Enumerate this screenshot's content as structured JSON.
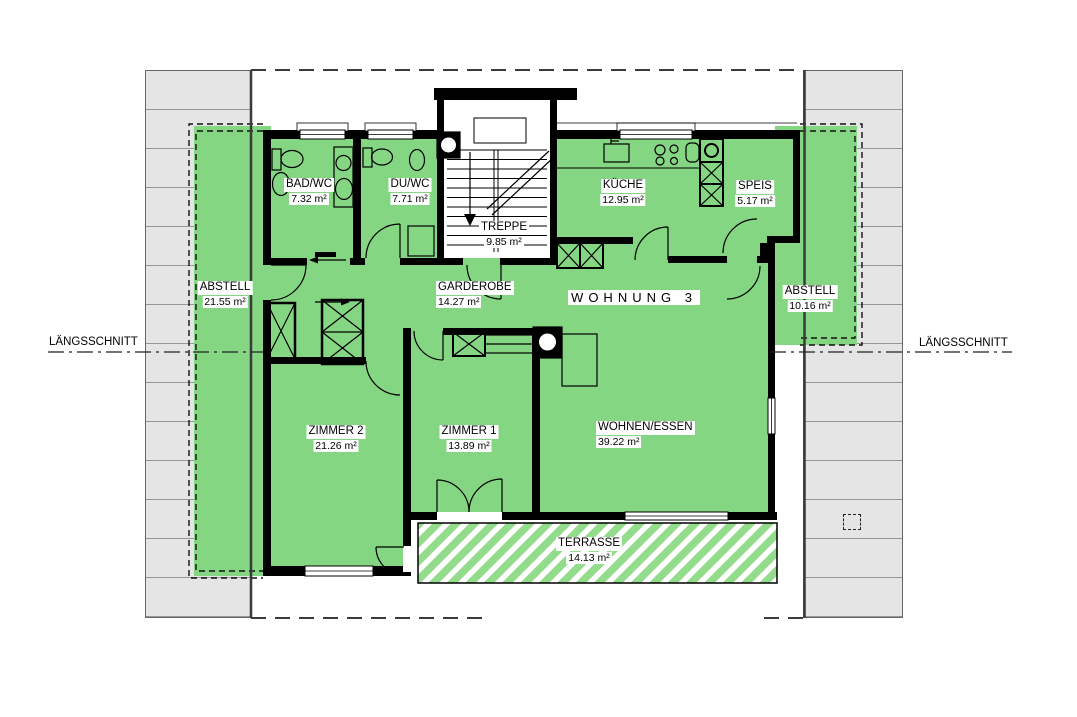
{
  "labels": {
    "apartment": "WOHNUNG 3",
    "section_left": "LÄNGSSCHNITT",
    "section_right": "LÄNGSSCHNITT"
  },
  "rooms": [
    {
      "id": "bad-wc",
      "name": "BAD/WC",
      "area": "7.32 m²"
    },
    {
      "id": "du-wc",
      "name": "DU/WC",
      "area": "7.71 m²"
    },
    {
      "id": "treppe",
      "name": "TREPPE",
      "area": "9.85 m²"
    },
    {
      "id": "kueche",
      "name": "KÜCHE",
      "area": "12.95 m²"
    },
    {
      "id": "speis",
      "name": "SPEIS",
      "area": "5.17 m²"
    },
    {
      "id": "abstell-left",
      "name": "ABSTELL",
      "area": "21.55 m²"
    },
    {
      "id": "garderobe",
      "name": "GARDEROBE",
      "area": "14.27 m²"
    },
    {
      "id": "abstell-right",
      "name": "ABSTELL",
      "area": "10.16 m²"
    },
    {
      "id": "zimmer-2",
      "name": "ZIMMER 2",
      "area": "21.26 m²"
    },
    {
      "id": "zimmer-1",
      "name": "ZIMMER 1",
      "area": "13.89 m²"
    },
    {
      "id": "wohnen-essen",
      "name": "WOHNEN/ESSEN",
      "area": "39.22 m²"
    },
    {
      "id": "terrasse",
      "name": "TERRASSE",
      "area": "14.13 m²"
    }
  ],
  "colors": {
    "green": "#85d682",
    "terrace_stripe": "#93dc8c",
    "wall": "#000000",
    "roof_fill": "#e5e5e5",
    "roof_line": "#979797",
    "roof_edge": "#3a3a3a"
  }
}
